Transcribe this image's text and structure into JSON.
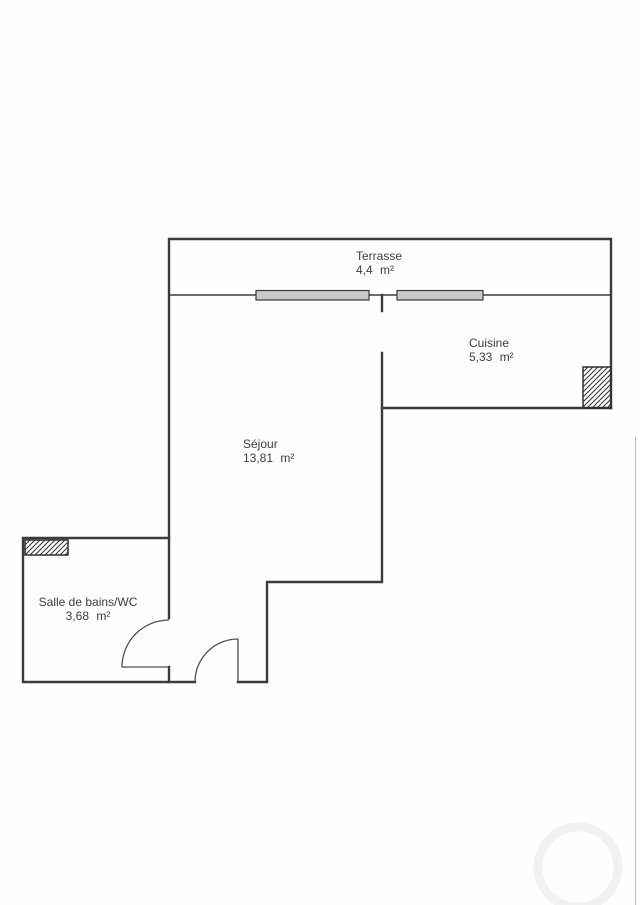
{
  "rooms": {
    "terrasse": {
      "name": "Terrasse",
      "area": "4,4 m²"
    },
    "cuisine": {
      "name": "Cuisine",
      "area": "5,33 m²"
    },
    "sejour": {
      "name": "Séjour",
      "area": "13,81 m²"
    },
    "salle_de_bains": {
      "name": "Salle de bains/WC",
      "area": "3,68 m²"
    }
  },
  "colors": {
    "wall": "#3b3b3b",
    "door": "#4f4f4f",
    "window_fill": "#c9c9c9",
    "hatch": "#2f2f2f",
    "text": "#3d3d3d",
    "page_edge": "#b8b8b8",
    "watermark": "#f1f1f1"
  }
}
